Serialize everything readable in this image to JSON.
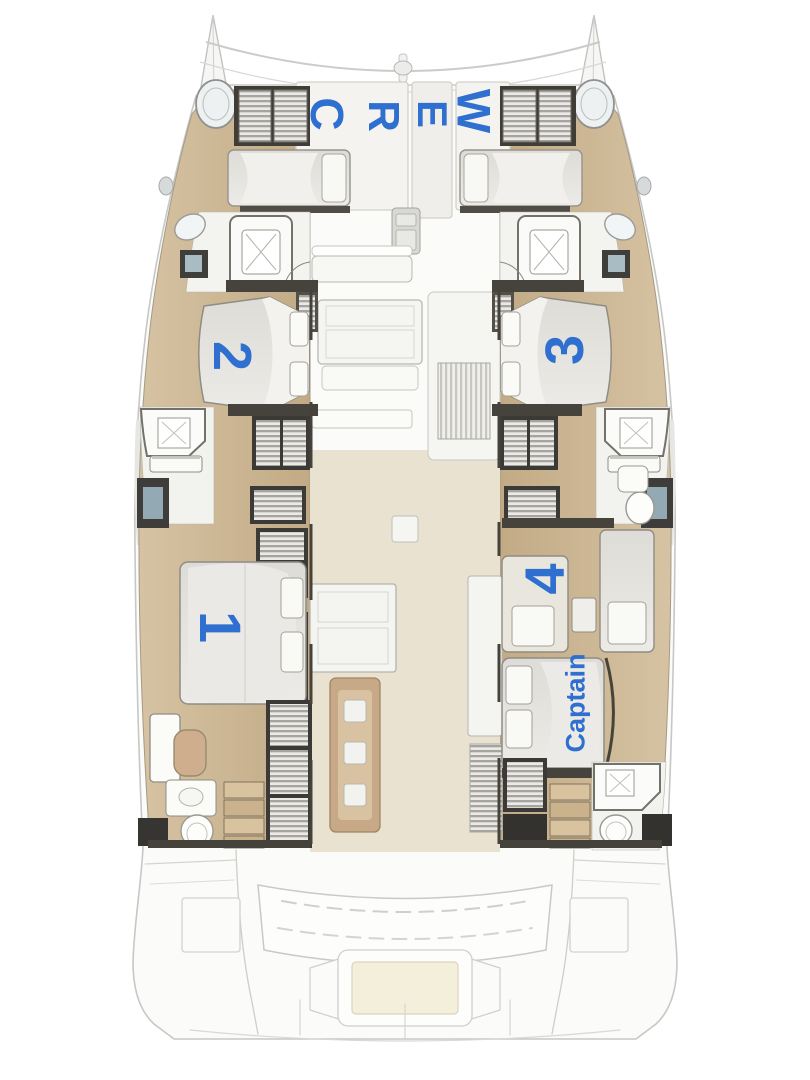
{
  "plan_labels": {
    "crew_letters": [
      "C",
      "R",
      "E",
      "W"
    ],
    "cabin_1": "1",
    "cabin_2": "2",
    "cabin_3": "3",
    "cabin_4": "4",
    "captain": "Captain"
  },
  "colors": {
    "label_blue": "#2e6fd0",
    "wood_floor": "#cdb795",
    "salon_floor": "#e9e2d0",
    "dark_walls": "#45423c",
    "bed_upholstery": "#e4e3df",
    "table_wood": "#c8a987",
    "faded_outline": "#c7c7c5"
  }
}
